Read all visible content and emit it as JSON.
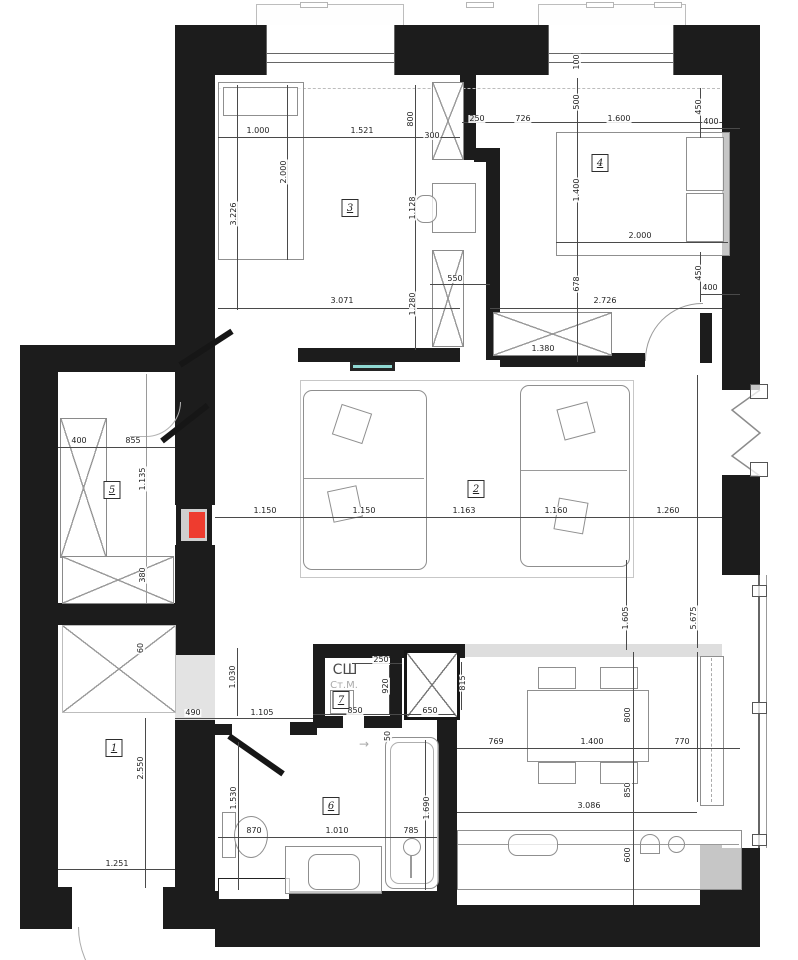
{
  "title": "apartment-floor-plan",
  "rooms": {
    "r1": "1",
    "r2": "2",
    "r3": "3",
    "r4": "4",
    "r5": "5",
    "r6": "6",
    "r7": "7"
  },
  "labels": {
    "closet_top": "СШ",
    "closet_mid": "Ст.М.",
    "entry_arrow": "→"
  },
  "colors": {
    "wall": "#1c1c1c",
    "dimension": "#4a4a4a",
    "furniture": "#8f8f8f",
    "accent_red": "#ee3c2f",
    "accent_teal": "#8fd8d2",
    "floor_gray": "#dedede"
  },
  "dimensions": {
    "d01": "1.000",
    "d02": "1.521",
    "d03": "800",
    "d04": "300",
    "d05": "250",
    "d06": "726",
    "d07": "100",
    "d08": "500",
    "d09": "1.600",
    "d10": "450",
    "d11": "400",
    "d12": "2.000",
    "d13": "3.226",
    "d14": "1.128",
    "d15": "1.400",
    "d16": "2.000",
    "d17": "550",
    "d18": "678",
    "d19": "450",
    "d20": "400",
    "d21": "3.071",
    "d22": "1.280",
    "d23": "2.726",
    "d24": "1.380",
    "d25": "1.150",
    "d26": "1.150",
    "d27": "1.163",
    "d28": "1.160",
    "d29": "1.260",
    "d30": "1.605",
    "d31": "5.675",
    "d32": "400",
    "d33": "855",
    "d34": "1.135",
    "d35": "380",
    "d36": "60",
    "d37": "1.030",
    "d38": "490",
    "d39": "1.105",
    "d40": "2.550",
    "d41": "1.251",
    "d42": "250",
    "d43": "920",
    "d44": "850",
    "d45": "650",
    "d46": "815",
    "d47": "50",
    "d48": "1.530",
    "d49": "870",
    "d50": "1.010",
    "d51": "785",
    "d52": "1.690",
    "d53": "769",
    "d54": "1.400",
    "d55": "770",
    "d56": "800",
    "d57": "850",
    "d58": "600",
    "d59": "3.086"
  }
}
